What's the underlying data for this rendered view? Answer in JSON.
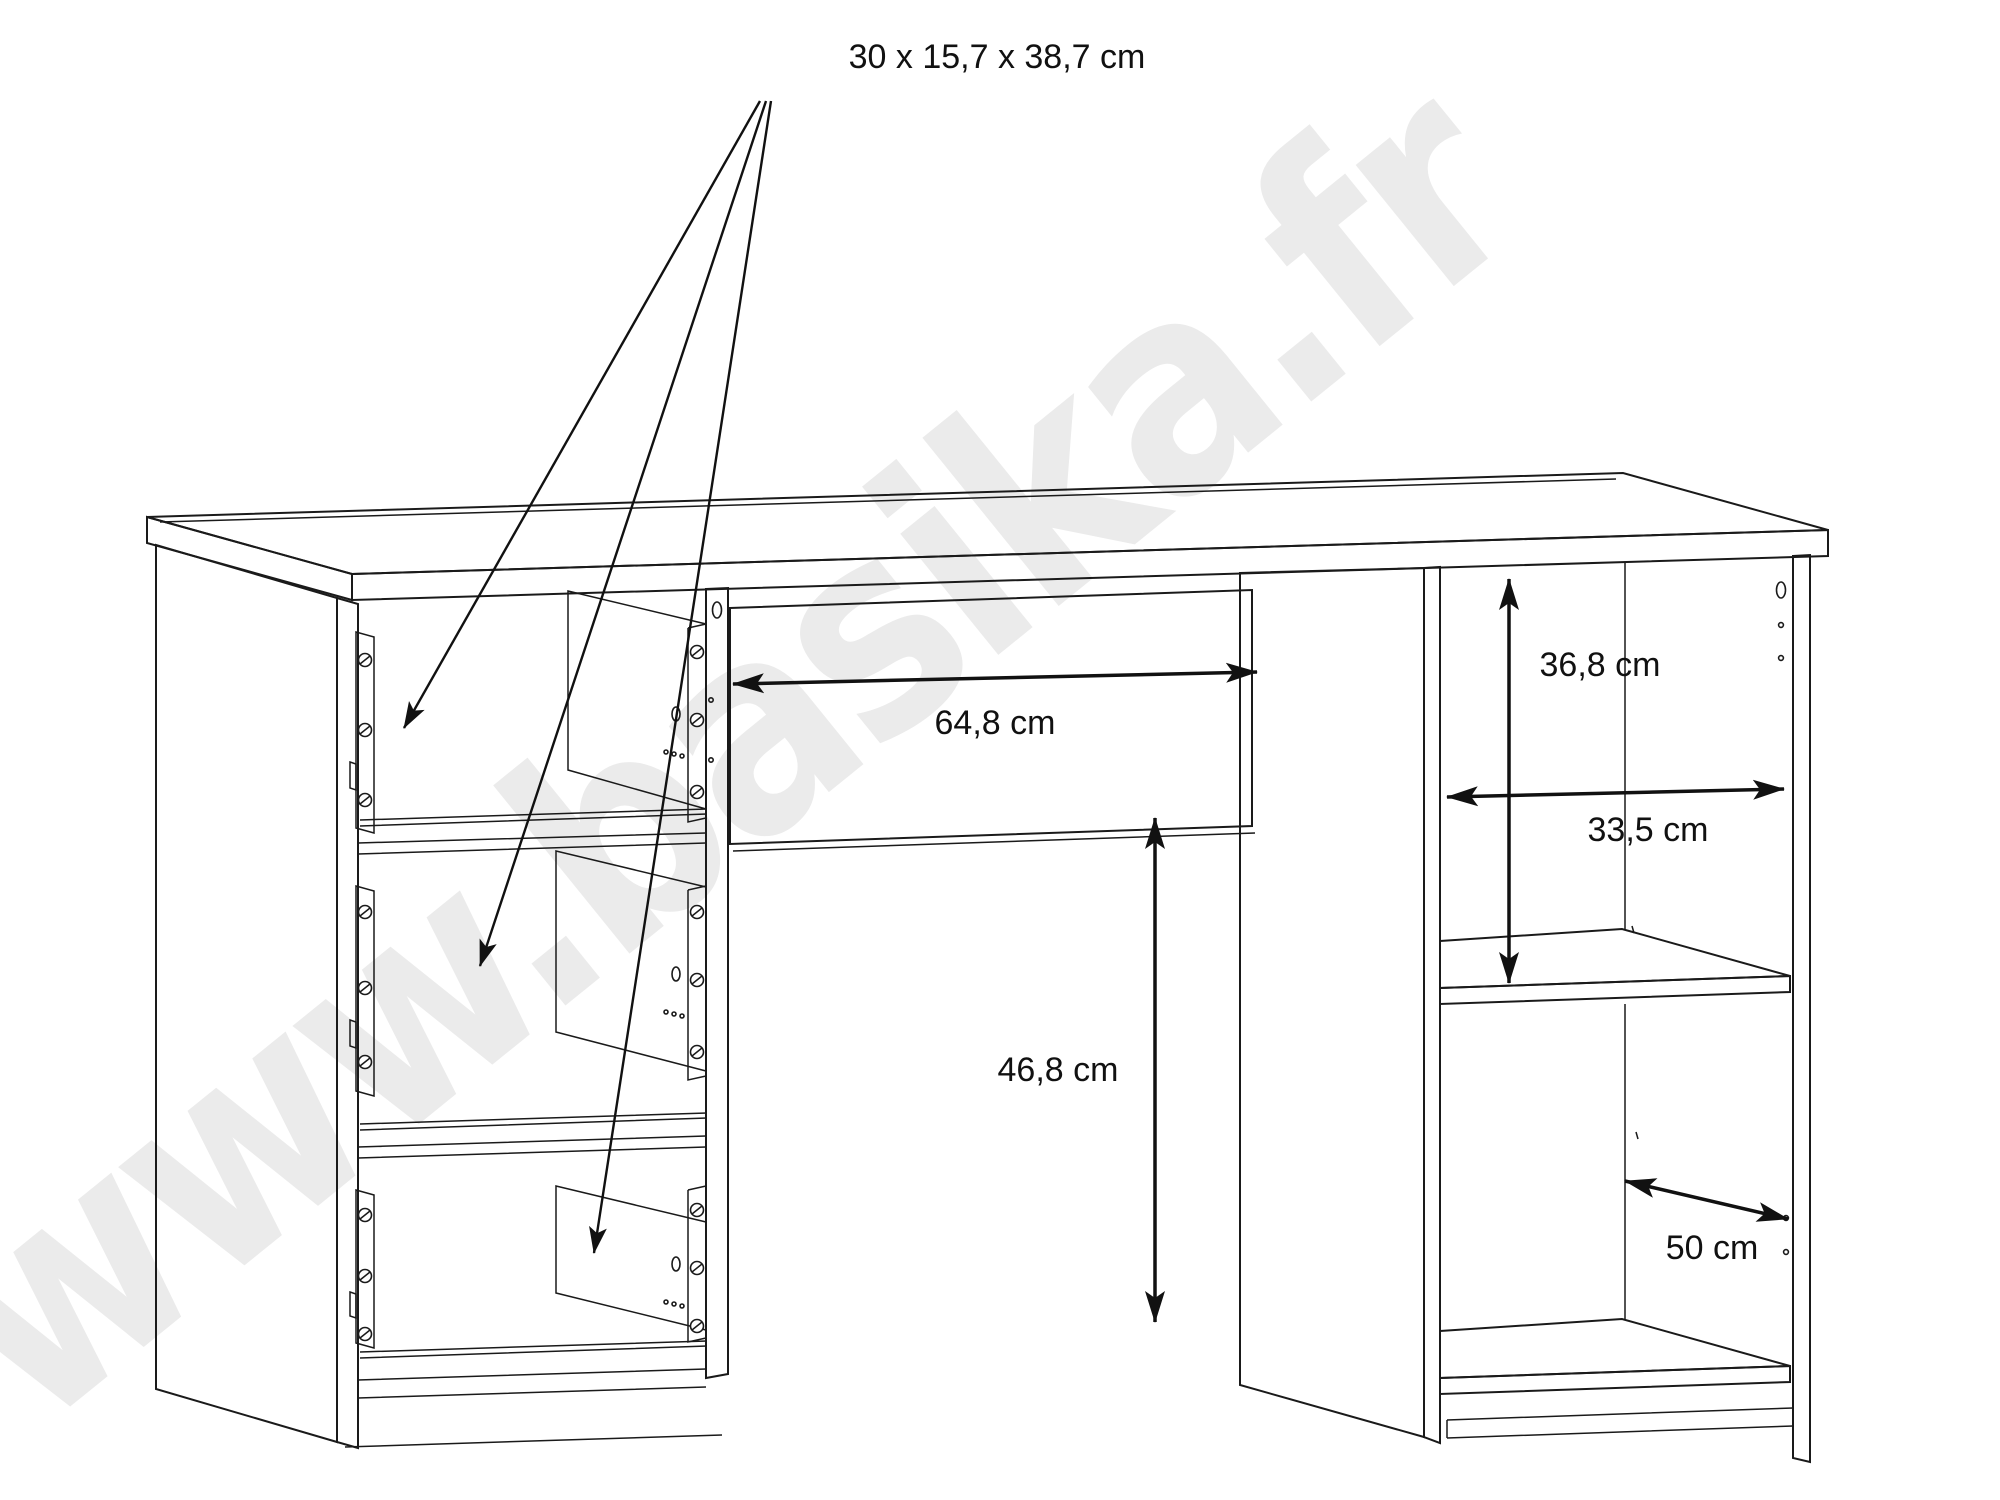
{
  "watermark": {
    "text": "www.basika.fr",
    "color": "#ebebeb"
  },
  "annotations": {
    "drawer_dims": "30 x 15,7 x 38,7 cm",
    "knee_width": "64,8 cm",
    "upper_compartment_height": "36,8 cm",
    "compartment_width": "33,5 cm",
    "under_drawer_height": "46,8 cm",
    "compartment_depth": "50 cm"
  },
  "colors": {
    "line": "#1a1a1a",
    "background": "#ffffff"
  }
}
